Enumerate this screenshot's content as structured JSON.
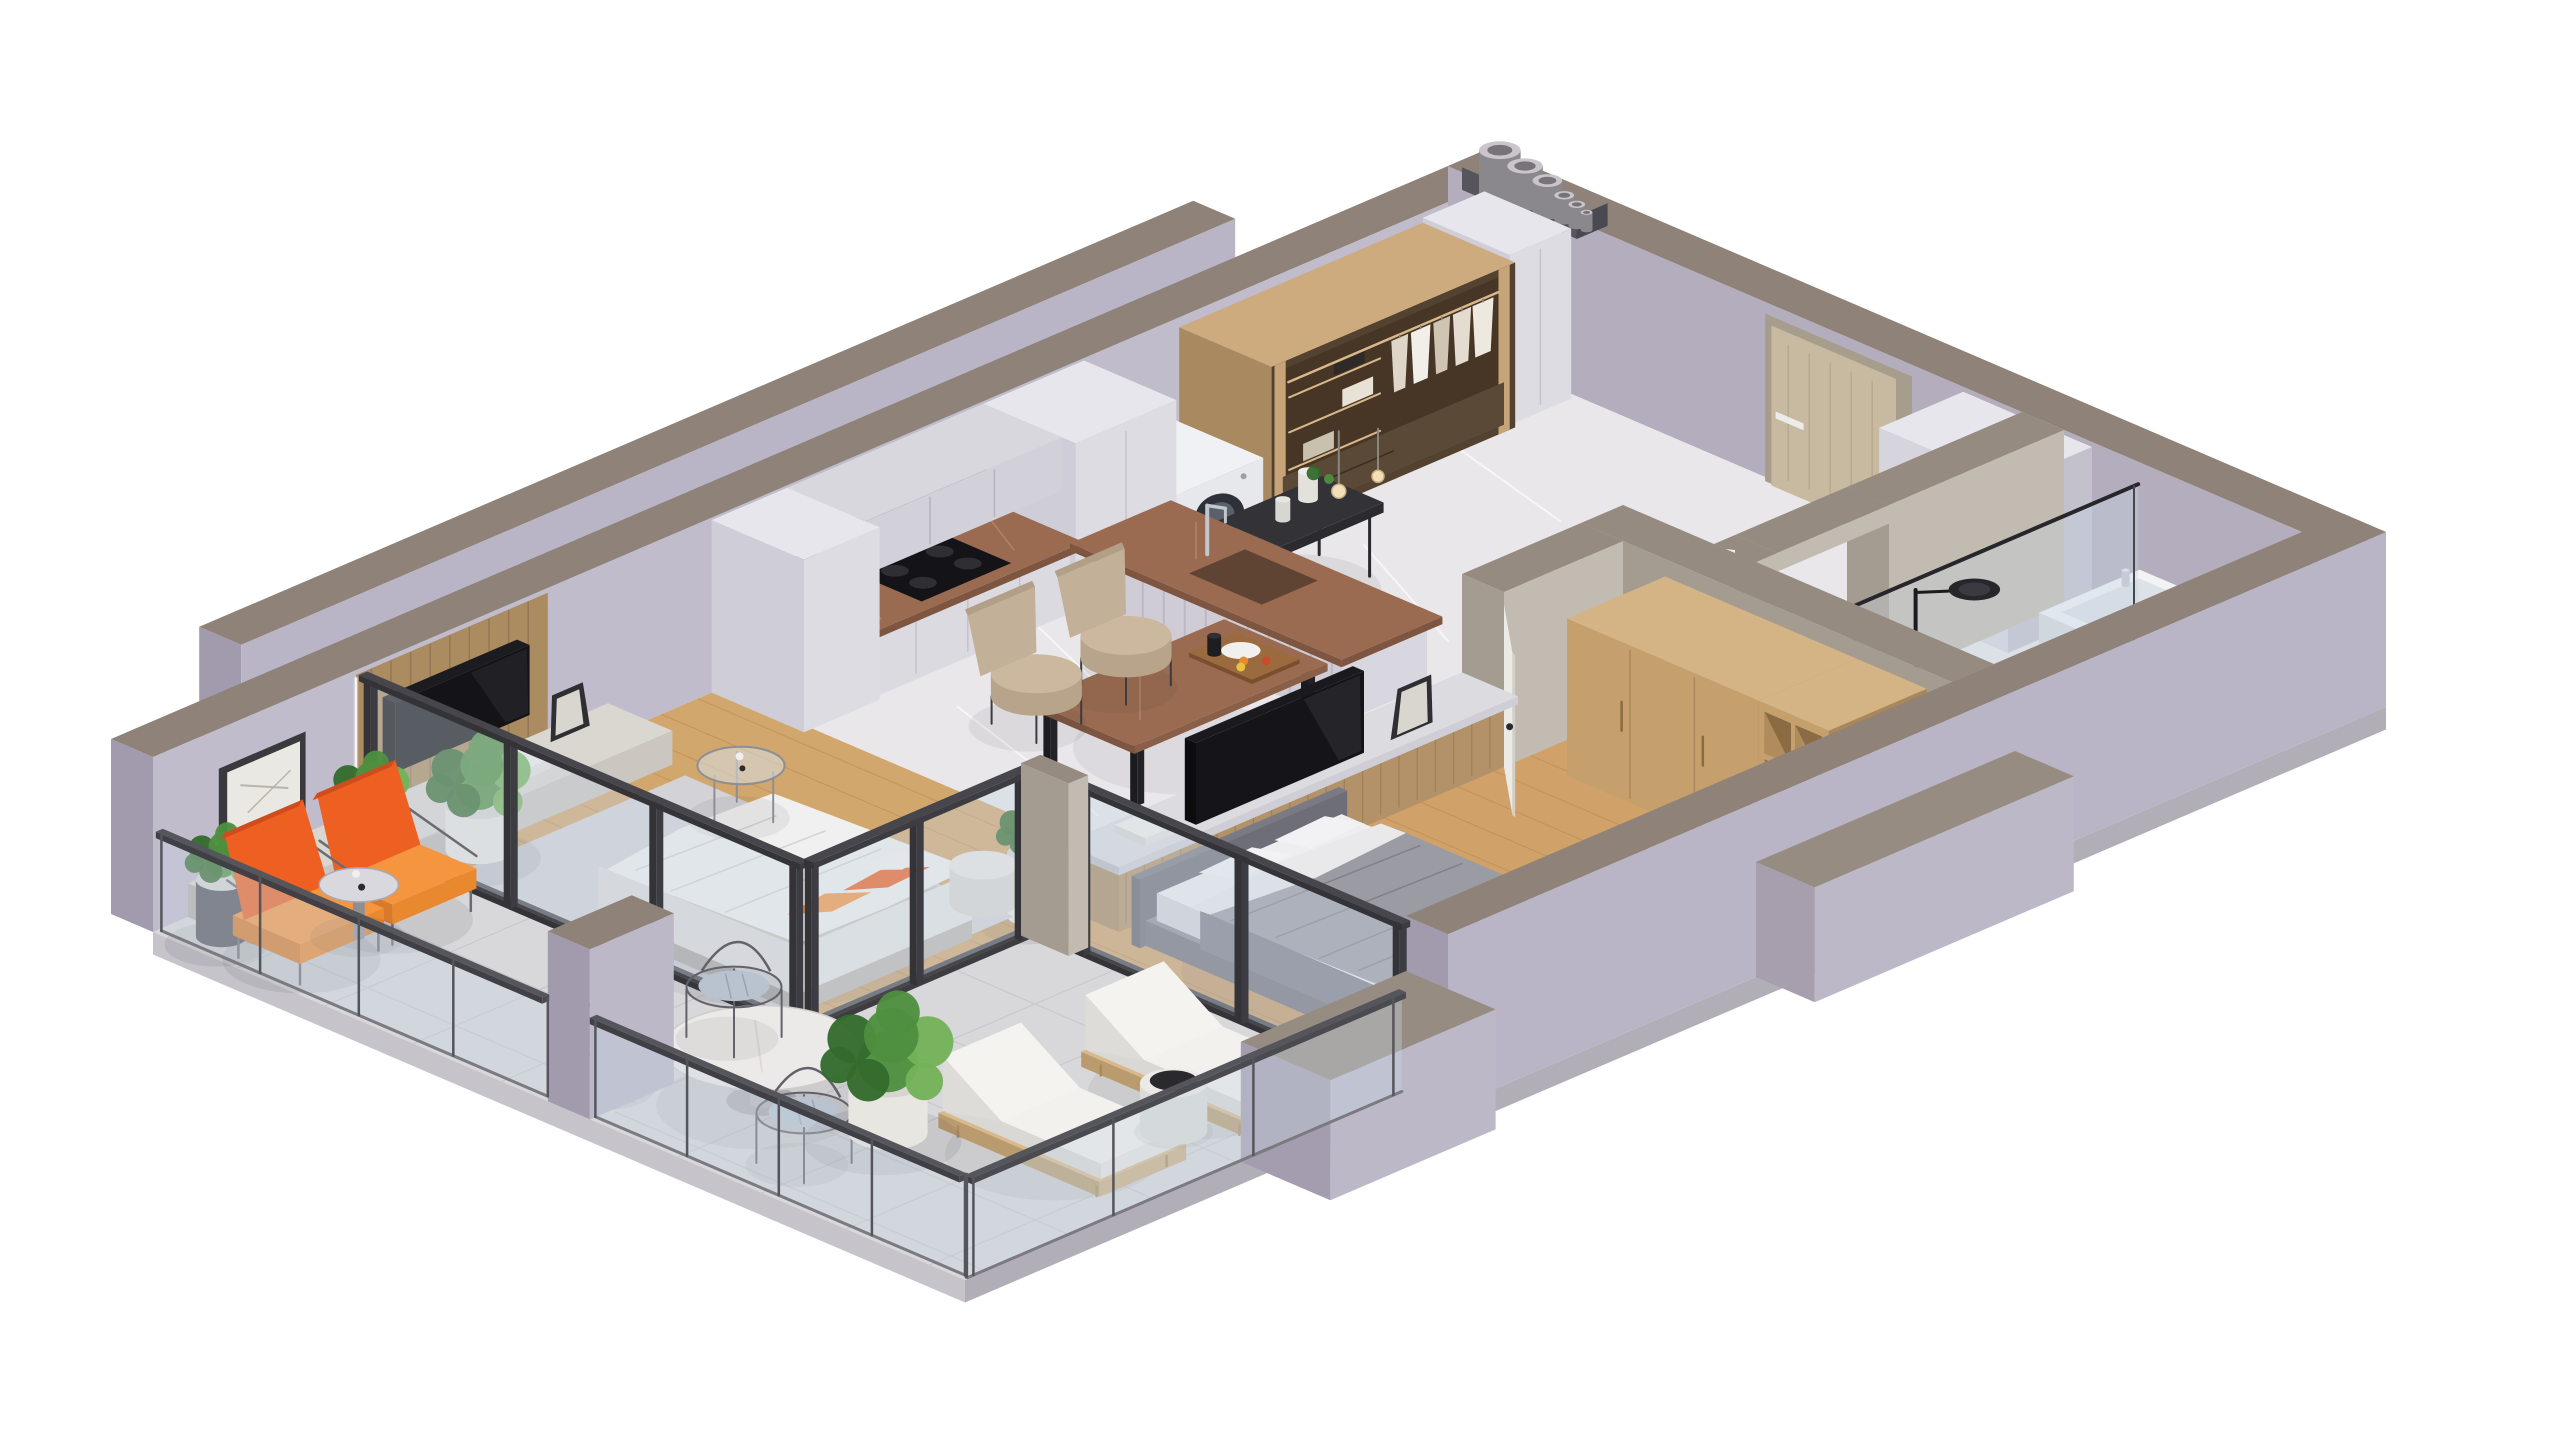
{
  "scene": {
    "title": "Isometric 3D cutaway floor-plan render of a one-bedroom apartment with balcony and terrace",
    "background": "#ffffff"
  },
  "palette": {
    "background": "#ffffff",
    "wall_top": "#8f8379",
    "wall_top_warm": "#968c82",
    "wall_inner": "#c0bccb",
    "wall_inner_dark": "#b3adbd",
    "wall_outer": "#b9b5c6",
    "wall_outer_dark": "#a19bad",
    "partition": "#c2bbb1",
    "partition_dark": "#a59c91",
    "partition_top": "#958b80",
    "skirt": "#c6c3cb",
    "skirt_dark": "#b2aeb8",
    "floor_marble": "#e9e7ea",
    "marble_vein": "#f8f8fa",
    "floor_wood": "#d0a269",
    "wood_seam": "#b8874e",
    "floor_stone": "#d8d7da",
    "stone_seam": "#c5c4c8",
    "rug": "#d3d2d7",
    "cabinet": "#e0dfe5",
    "cabinet_dark": "#c7c6d0",
    "counter_brown": "#9a6b50",
    "counter_brown_dark": "#7d5540",
    "backsplash_dark": "#3a2f28",
    "niche_dark": "#232327",
    "wood_panel": "#ab8b60",
    "wood_panel_dark": "#8f7350",
    "dark_wood": "#553f30",
    "dark_wood_deep": "#3b2c21",
    "frame_wood": "#c7a478",
    "light_wood": "#c5a06c",
    "light_wood_dark": "#a9875a",
    "door_beige": "#c8baa0",
    "door_frame": "#a79d8c",
    "white_goods": "#eceef1",
    "black": "#17171b",
    "black_soft": "#2a2a2e",
    "chrome": "#c2c6cd",
    "orange": "#ee5f22",
    "orange_light": "#f6953f",
    "green": "#4e8f3f",
    "green_dark": "#336b2d",
    "green_light": "#74b258",
    "bed_white": "#efeff2",
    "bed_gray": "#9b9ba4",
    "bed_gray_dark": "#7f7f89",
    "beige_chair": "#c3b098",
    "glass": "rgba(200,214,226,0.38)",
    "glass_edge": "rgba(100,110,125,0.55)",
    "metal_rail": "#4a4a50",
    "art_bg": "#eae8e2",
    "art_line": "#b5b0a6",
    "pot_white": "#e8e6e1",
    "pipe": "#c9c5c9",
    "pipe_dark": "#8b888d",
    "shadow": "#3a3a45"
  },
  "rooms": [
    {
      "id": "entry-hall",
      "label": "Entry hall",
      "floor": "white marble",
      "furniture": [
        "entrance-door",
        "open-wardrobe",
        "hanging-clothes",
        "tall-white-cabinet",
        "washing-machine",
        "black-console-table",
        "pendant-lights",
        "double-wardrobe",
        "utility-pipes"
      ]
    },
    {
      "id": "kitchen",
      "label": "Kitchen",
      "floor": "white marble",
      "furniture": [
        "tall-cabinet-columns",
        "base-cabinets",
        "brown-marble-countertop",
        "induction-cooktop",
        "dark-backsplash",
        "upper-cabinets",
        "peninsula-bar",
        "sink",
        "chrome-faucet",
        "dining-table",
        "breakfast-tray",
        "dining-chairs"
      ]
    },
    {
      "id": "living-room",
      "label": "Living room",
      "floor": "oak planks",
      "furniture": [
        "tv-wood-panel",
        "wall-tv",
        "framed-art",
        "low-media-console",
        "sofa-bed",
        "orange-cushions",
        "rug",
        "glass-side-table",
        "pouf",
        "potted-plants"
      ]
    },
    {
      "id": "bathroom",
      "label": "Bathroom",
      "floor": "marble and oak",
      "furniture": [
        "bathroom-door",
        "glass-shower-screen",
        "black-shower-set",
        "bathtub"
      ]
    },
    {
      "id": "bedroom",
      "label": "Bedroom",
      "floor": "oak planks",
      "furniture": [
        "bedroom-door",
        "double-bed",
        "gray-duvet",
        "wood-wardrobe",
        "open-shelf-cubes",
        "tv-console",
        "bedroom-tv",
        "leaning-art",
        "potted-plant"
      ]
    },
    {
      "id": "balcony",
      "label": "Balcony",
      "floor": "stone tiles",
      "furniture": [
        "orange-armchairs",
        "round-side-table",
        "potted-plants",
        "glass-railing"
      ]
    },
    {
      "id": "terrace",
      "label": "Terrace",
      "floor": "stone tiles",
      "furniture": [
        "round-dining-table",
        "wire-chairs",
        "sun-loungers",
        "side-table",
        "large-potted-plant",
        "glass-railing"
      ]
    }
  ]
}
